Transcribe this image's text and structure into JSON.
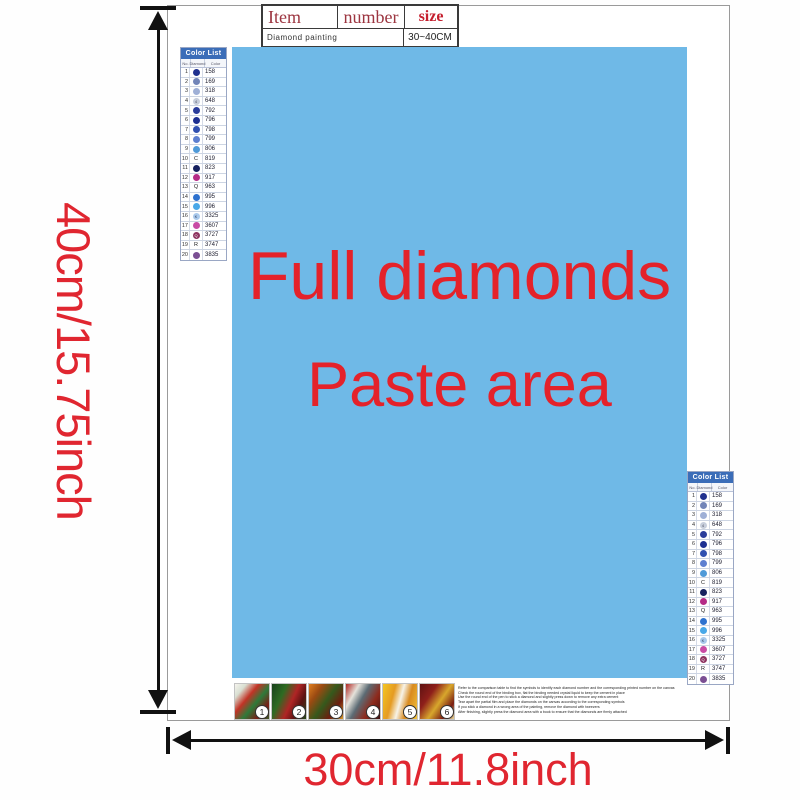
{
  "dimension_labels": {
    "height": "40cm/15.75inch",
    "width": "30cm/11.8inch",
    "color": "#e02630"
  },
  "spec_table": {
    "headers": [
      "Item",
      "number",
      "size"
    ],
    "row": {
      "item": "Diamond painting",
      "size": "30~40CM"
    }
  },
  "paste_area": {
    "line1": "Full diamonds",
    "line2": "Paste area",
    "bg": "#6fb9e7",
    "text_color": "#e4222a"
  },
  "color_list": {
    "title": "Color List",
    "columns": [
      "No.",
      "Diamond",
      "Color"
    ],
    "rows": [
      {
        "no": "1",
        "code": "158",
        "dot": "#20318f",
        "sym": "",
        "sym_color": "#ffffff"
      },
      {
        "no": "2",
        "code": "169",
        "dot": "#7285b8",
        "sym": "",
        "sym_color": "#ffffff"
      },
      {
        "no": "3",
        "code": "318",
        "dot": "#9fb0d6",
        "sym": "",
        "sym_color": "#ffffff"
      },
      {
        "no": "4",
        "code": "648",
        "dot": "#c7cedb",
        "sym": "4",
        "sym_color": "#555566"
      },
      {
        "no": "5",
        "code": "792",
        "dot": "#2b3d9b",
        "sym": "",
        "sym_color": "#ffffff"
      },
      {
        "no": "6",
        "code": "796",
        "dot": "#1d2f91",
        "sym": "",
        "sym_color": "#ffffff"
      },
      {
        "no": "7",
        "code": "798",
        "dot": "#3050b0",
        "sym": "",
        "sym_color": "#ffffff"
      },
      {
        "no": "8",
        "code": "799",
        "dot": "#5d7fd0",
        "sym": "",
        "sym_color": "#ffffff"
      },
      {
        "no": "9",
        "code": "806",
        "dot": "#4f9ad8",
        "sym": "",
        "sym_color": "#ffffff"
      },
      {
        "no": "10",
        "code": "819",
        "dot": null,
        "sym": "C",
        "sym_color": "#222222"
      },
      {
        "no": "11",
        "code": "823",
        "dot": "#16215f",
        "sym": "",
        "sym_color": "#ffffff"
      },
      {
        "no": "12",
        "code": "917",
        "dot": "#b52b86",
        "sym": "",
        "sym_color": "#ffffff"
      },
      {
        "no": "13",
        "code": "963",
        "dot": null,
        "sym": "Q",
        "sym_color": "#222222"
      },
      {
        "no": "14",
        "code": "995",
        "dot": "#2e72cf",
        "sym": "",
        "sym_color": "#ffffff"
      },
      {
        "no": "15",
        "code": "996",
        "dot": "#49a8e8",
        "sym": "",
        "sym_color": "#ffffff"
      },
      {
        "no": "16",
        "code": "3325",
        "dot": "#a9c9ec",
        "sym": "K",
        "sym_color": "#334466"
      },
      {
        "no": "17",
        "code": "3607",
        "dot": "#c94ba5",
        "sym": "",
        "sym_color": "#ffffff"
      },
      {
        "no": "18",
        "code": "3727",
        "dot": "#8e3360",
        "sym": "Q",
        "sym_color": "#ffffff"
      },
      {
        "no": "19",
        "code": "3747",
        "dot": null,
        "sym": "R",
        "sym_color": "#222222"
      },
      {
        "no": "20",
        "code": "3835",
        "dot": "#7b4f93",
        "sym": "",
        "sym_color": "#ffffff"
      }
    ]
  },
  "thumbnails": [
    {
      "num": "1"
    },
    {
      "num": "2"
    },
    {
      "num": "3"
    },
    {
      "num": "4"
    },
    {
      "num": "5"
    },
    {
      "num": "6"
    }
  ],
  "instructions_lines": [
    "Refer to the comparison table to find the symbols to identify each diamond number and the corresponding printed number on the canvas",
    "Check the round end of the binding box, flat the binding needed crystal liquid to keep the cement in place",
    "Use the round end of the pen to stick a diamond and slightly press down to remove any extra cement",
    "Tear apart the partial film and place the diamonds on the canvas according to the corresponding symbols",
    "If you stick a diamond in a wrong area of the painting, remove the diamond with tweezers",
    "After finishing, slightly press the diamond area with a book to ensure that the diamonds are firmly attached"
  ]
}
